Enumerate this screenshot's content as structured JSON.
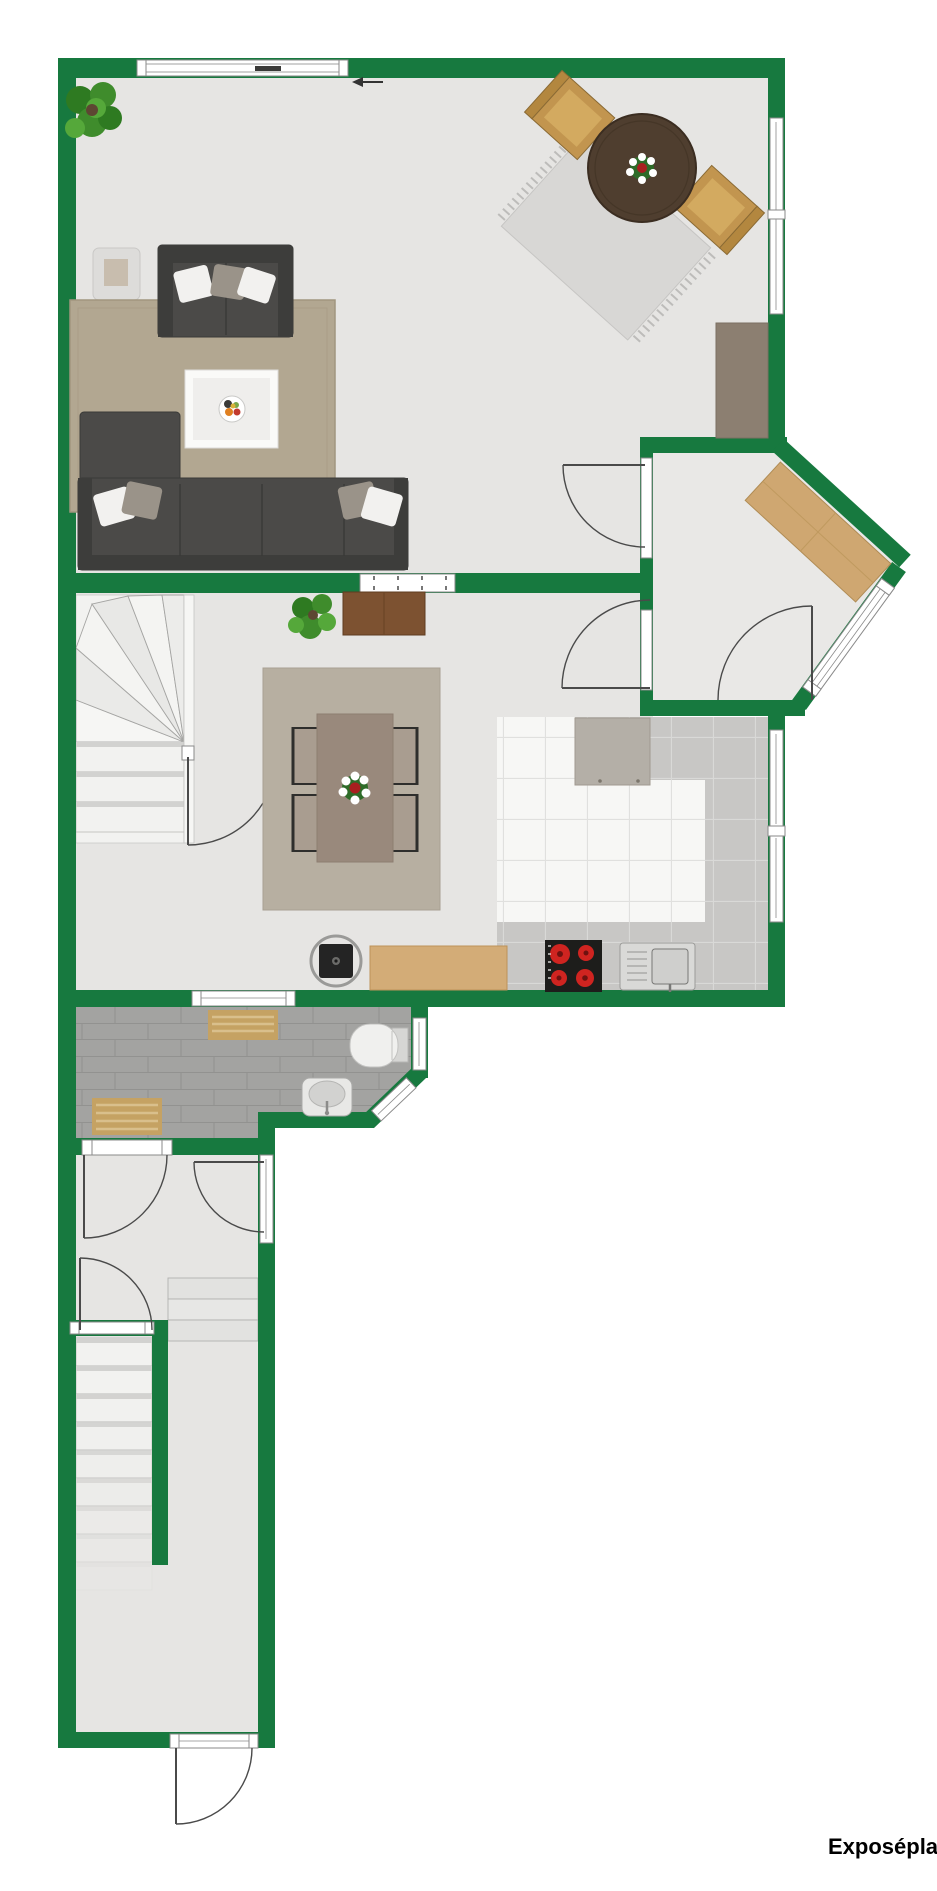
{
  "caption": "Exposéplan",
  "icons": {
    "direction_arrow": "←"
  },
  "colors": {
    "wall": "#17793f",
    "line": "#4a4a4a",
    "frame": "#ffffff",
    "frame_edge": "#8a8a8a",
    "floor": "#e6e5e3",
    "floor_entry": "#e9e8e6",
    "living_rug": "#b2a791",
    "dining_rug": "#b7afa1",
    "sofa": "#4b4a48",
    "sofa_dark": "#3d3d3b",
    "pillow_white": "#f2f1ef",
    "pillow_gray": "#9a9389",
    "coffee_outer": "#fafaf8",
    "coffee_inner": "#efeeec",
    "side_table": "#dddcda",
    "side_table_inner": "#c8bdae",
    "wood_chair": "#c2954f",
    "wood_chair_seat": "#d3aa60",
    "round_table": "#4f3e2f",
    "small_rug": "#d8d7d5",
    "sideboard_taupe": "#8c7f71",
    "sideboard_wood": "#7d5231",
    "dining_table_wood": "#99897c",
    "chair_seat": "#a99d90",
    "plant": "#3f8c2c",
    "plant_dark": "#2e7a21",
    "bench": "#cfa771",
    "bath_tile": "#a3a3a1",
    "bath_line": "#929290",
    "bath_mat": "#c5a263",
    "mat_stripe": "#d9bf8c",
    "kitchen_tile": "#f7f7f5",
    "tile_line": "#dcdcda",
    "counter": "#c8c7c5",
    "appliance": "#b4afa7",
    "cooktop": "#1d1d1b",
    "burner": "#cf2420",
    "sink_metal": "#d9d9d7",
    "porcelain": "#f0f0ee",
    "stair": "#f2f2f0",
    "stair_shadow": "#d2d2d0",
    "caption": "#000000"
  }
}
